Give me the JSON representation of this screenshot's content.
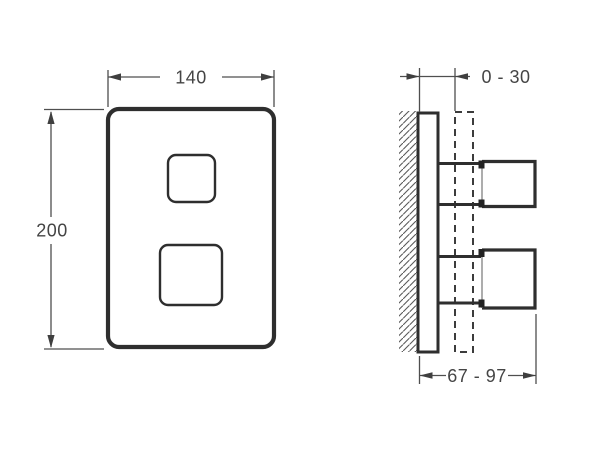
{
  "page": {
    "background": "#ffffff"
  },
  "drawing": {
    "colors": {
      "outline": "#2e2e2e",
      "dimension_line": "#4f4f4f",
      "text": "#454545",
      "dashed_outline": "#3c3c3c",
      "hatch": "#5a5a5a"
    },
    "front_view": {
      "width_label": "140",
      "height_label": "200"
    },
    "side_view": {
      "wall_offset_label": "0 - 30",
      "depth_label": "67 - 97"
    }
  }
}
